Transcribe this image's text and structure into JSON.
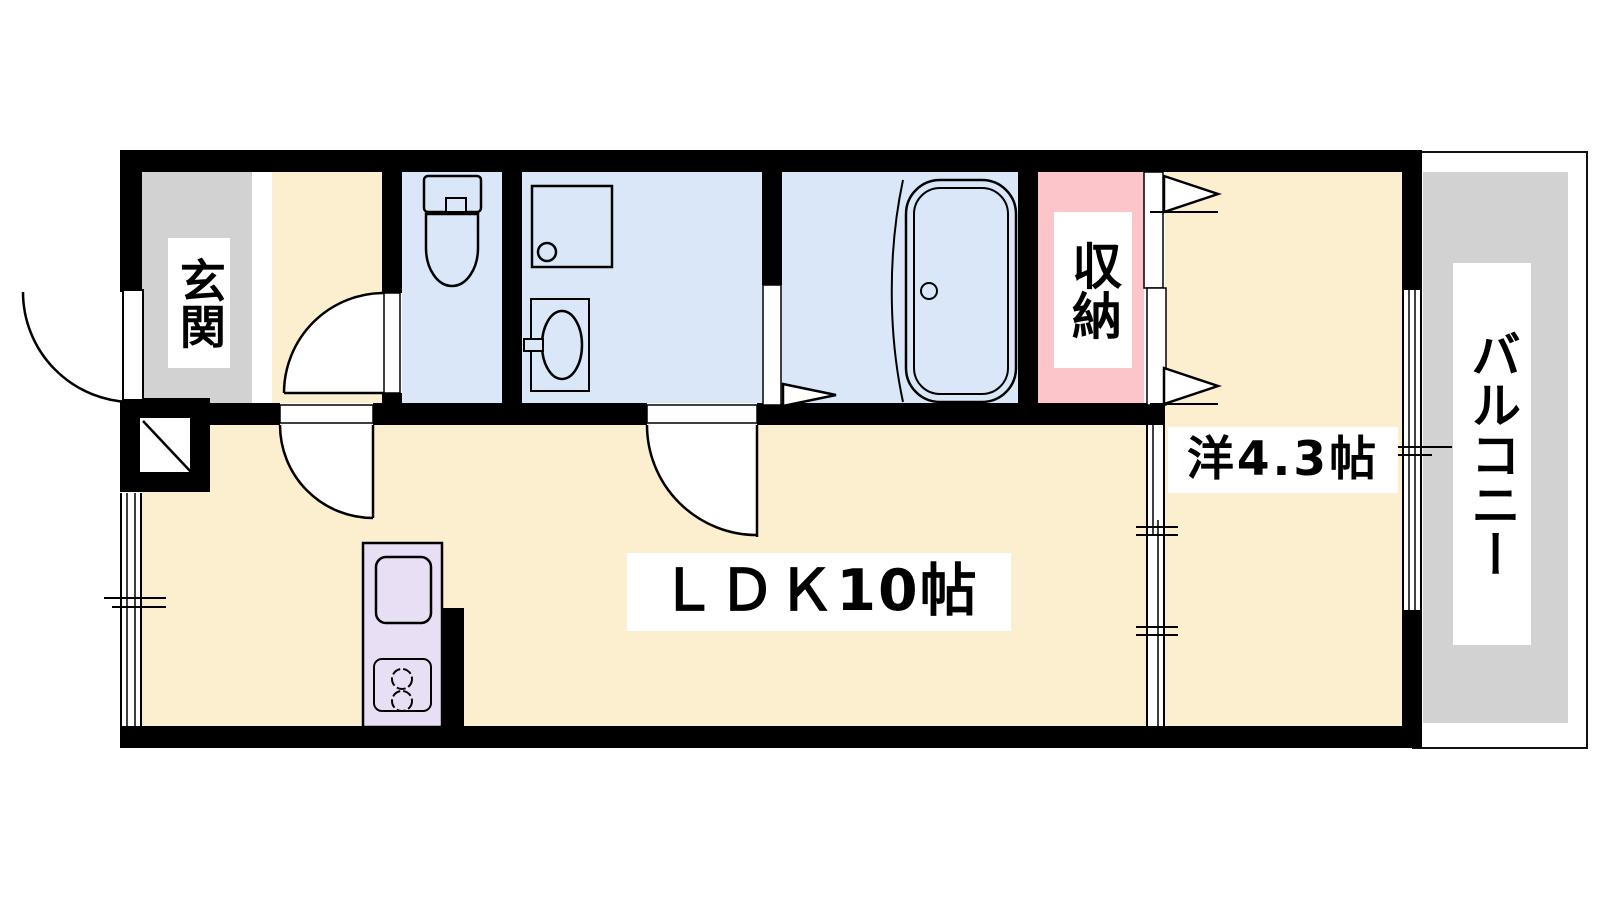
{
  "plan_title": "apartment floor plan",
  "rooms": {
    "genkan": {
      "label": "玄関"
    },
    "ldk": {
      "label": "ＬＤＫ10帖"
    },
    "western": {
      "label": "洋4.3帖"
    },
    "storage": {
      "label": "収納"
    },
    "balcony": {
      "label": "バルコニー"
    }
  },
  "unlabeled_rooms": [
    "toilet",
    "washroom",
    "bathroom"
  ],
  "fixtures": [
    "toilet",
    "washing-machine-pan",
    "washbasin",
    "bathtub",
    "kitchen-sink",
    "two-burner-stove"
  ],
  "colors": {
    "room_cream": "#fcefd0",
    "wet_area_blue": "#dae7f8",
    "storage_pink": "#fbc5c9",
    "entrance_gray": "#d2d2d2",
    "kitchen_lavender": "#e9dff5",
    "wall_black": "#000000",
    "label_bg": "#ffffff"
  }
}
